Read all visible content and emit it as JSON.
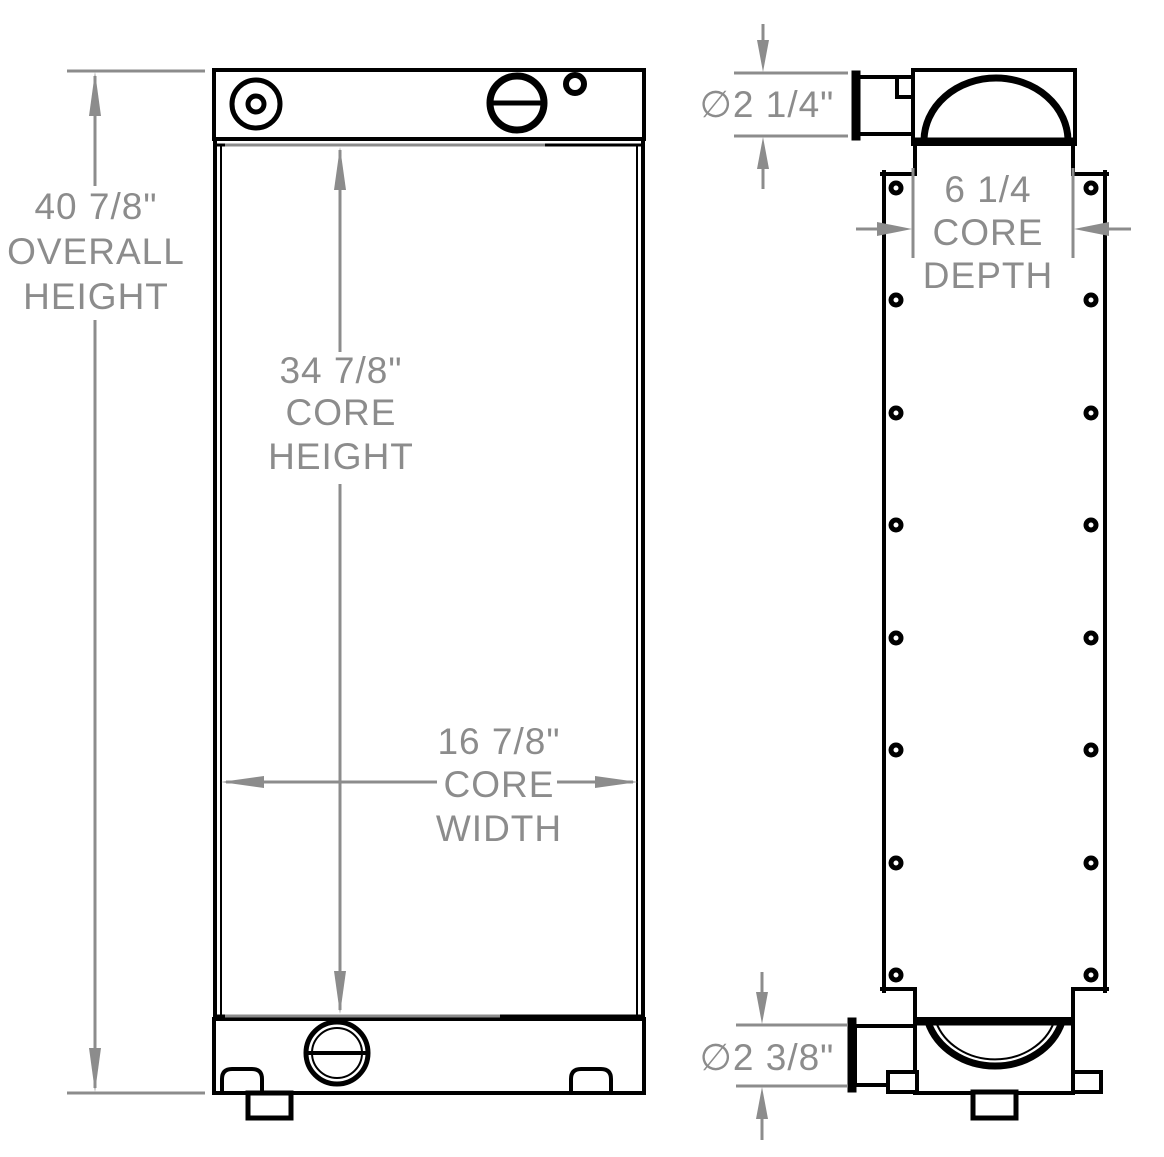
{
  "dimensions": {
    "overall_height": [
      "40 7/8\"",
      "OVERALL",
      "HEIGHT"
    ],
    "core_height": [
      "34 7/8\"",
      "CORE",
      "HEIGHT"
    ],
    "core_width": [
      "16 7/8\"",
      "CORE",
      "WIDTH"
    ],
    "core_depth": [
      "6 1/4",
      "CORE",
      "DEPTH"
    ],
    "top_port_diameter": "∅2 1/4\"",
    "bottom_port_diameter": "∅2 3/8\""
  },
  "colors": {
    "drawing_line": "#000000",
    "dimension": "#8c8c8c",
    "background": "#ffffff"
  }
}
